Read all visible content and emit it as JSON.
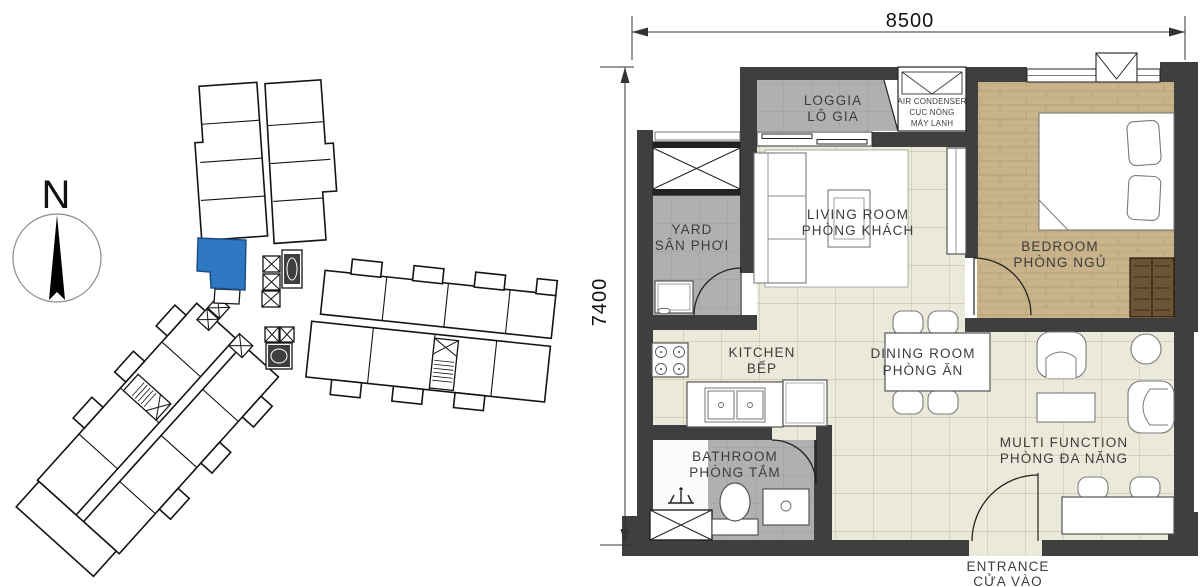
{
  "site": {
    "compass_label": "N",
    "highlight_color": "#2E77C3"
  },
  "floor_plan": {
    "dimensions": {
      "width": "8500",
      "height": "7400"
    },
    "rooms": {
      "loggia": {
        "en": "LOGGIA",
        "vi": "LÔ GIA"
      },
      "air_condenser": {
        "l1": "AIR CONDENSER",
        "l2": "CỤC NÓNG",
        "l3": "MÁY LẠNH"
      },
      "yard": {
        "en": "YARD",
        "vi": "SÂN PHƠI"
      },
      "living_room": {
        "en": "LIVING ROOM",
        "vi": "PHÒNG KHÁCH"
      },
      "bedroom": {
        "en": "BEDROOM",
        "vi": "PHÒNG NGỦ"
      },
      "kitchen": {
        "en": "KITCHEN",
        "vi": "BẾP"
      },
      "dining_room": {
        "en": "DINING ROOM",
        "vi": "PHÒNG ĂN"
      },
      "bathroom": {
        "en": "BATHROOM",
        "vi": "PHÒNG TẮM"
      },
      "multi_function": {
        "en": "MULTI FUNCTION",
        "vi": "PHÒNG ĐA NĂNG"
      },
      "entrance": {
        "en": "ENTRANCE",
        "vi": "CỬA VÀO"
      }
    },
    "colors": {
      "wall": "#3F3F3F",
      "floor": "#EBE9DA",
      "wet_area": "#B2B2B2",
      "wood": "#C9B38A"
    }
  }
}
